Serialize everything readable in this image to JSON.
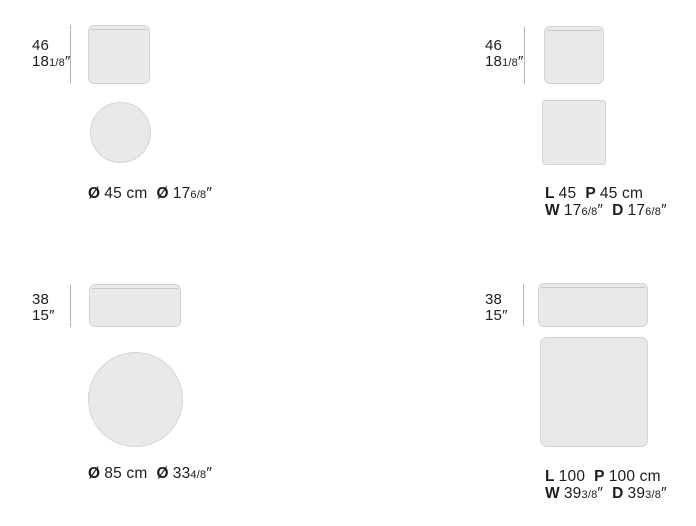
{
  "colors": {
    "background": "#ffffff",
    "shape_fill": "#e8e9e9",
    "shape_border": "#d3d4d4",
    "seam_line": "#c8c9c9",
    "dimension_line": "#b4b5b5",
    "text": "#1d1d1b"
  },
  "products": [
    {
      "type": "round-pouf-45",
      "height": {
        "cm": "46",
        "inch": "18",
        "inch_frac": "1/8",
        "unit": "″"
      },
      "label": {
        "sym1": "Ø",
        "val1": "45 cm",
        "sym2": "Ø",
        "val2": "17",
        "frac2": "6/8",
        "unit2": "″"
      }
    },
    {
      "type": "square-pouf-45",
      "height": {
        "cm": "46",
        "inch": "18",
        "inch_frac": "1/8",
        "unit": "″"
      },
      "label_line1": {
        "k1": "L",
        "v1": "45",
        "k2": "P",
        "v2": "45 cm"
      },
      "label_line2": {
        "k1": "W",
        "v1": "17",
        "f1": "6/8",
        "u1": "″",
        "k2": "D",
        "v2": "17",
        "f2": "6/8",
        "u2": "″"
      }
    },
    {
      "type": "round-pouf-85",
      "height": {
        "cm": "38",
        "inch": "15",
        "inch_frac": "",
        "unit": "″"
      },
      "label": {
        "sym1": "Ø",
        "val1": "85 cm",
        "sym2": "Ø",
        "val2": "33",
        "frac2": "4/8",
        "unit2": "″"
      }
    },
    {
      "type": "square-pouf-100",
      "height": {
        "cm": "38",
        "inch": "15",
        "inch_frac": "",
        "unit": "″"
      },
      "label_line1": {
        "k1": "L",
        "v1": "100",
        "k2": "P",
        "v2": "100 cm"
      },
      "label_line2": {
        "k1": "W",
        "v1": "39",
        "f1": "3/8",
        "u1": "″",
        "k2": "D",
        "v2": "39",
        "f2": "3/8",
        "u2": "″"
      }
    }
  ]
}
